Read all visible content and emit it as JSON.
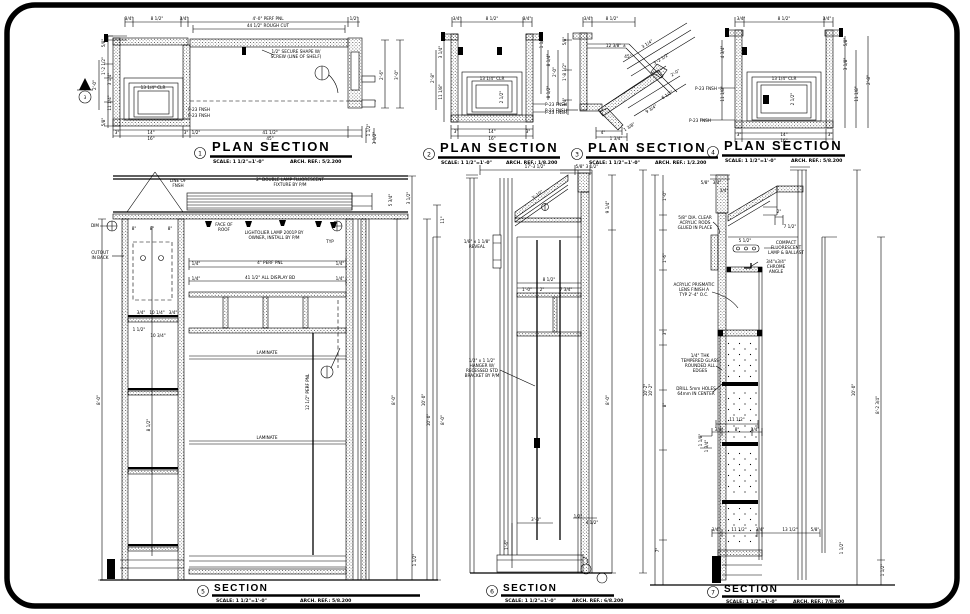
{
  "sheet": {
    "background": "#ffffff",
    "line_color": "#000000"
  },
  "panels": {
    "p1": {
      "num": "1",
      "title": "PLAN SECTION",
      "scale": "SCALE: 1 1/2\"=1'-0\"",
      "ref": "ARCH. REF.: 5/2.200",
      "ann": [
        [
          "3/4\"",
          129,
          20
        ],
        [
          "8 1/2\"",
          157,
          20
        ],
        [
          "3/4\"",
          184,
          20
        ],
        [
          "4'-0\" PERF PNL",
          268,
          20
        ],
        [
          "1/2\"",
          354,
          20
        ],
        [
          "44 1/2\" ROUGH CUT",
          268,
          27
        ],
        [
          "1/2\" SECURE SHAPE W/",
          296,
          53
        ],
        [
          "SCREW (LINE OF SHELF)",
          296,
          58
        ],
        [
          "5/8\"",
          105,
          43,
          -90
        ],
        [
          "1'-2 1/2\"",
          105,
          66,
          -90
        ],
        [
          "3 1/4\"",
          111,
          79,
          -90
        ],
        [
          "11 1/4\"",
          111,
          103,
          -90
        ],
        [
          "5/8\"",
          105,
          122,
          -90
        ],
        [
          "2'-0\"",
          96,
          85,
          -90
        ],
        [
          "13 1/4\" CLR",
          153,
          89
        ],
        [
          "P-23 FNSH",
          199,
          111
        ],
        [
          "P-23 FNSH",
          199,
          117
        ],
        [
          "3\"",
          117,
          134
        ],
        [
          "14\"",
          151,
          134
        ],
        [
          "3\"",
          186,
          134
        ],
        [
          "1/2\"",
          196,
          134
        ],
        [
          "41 1/2\"",
          270,
          134
        ],
        [
          "16\"",
          151,
          140
        ],
        [
          "45\"",
          270,
          140
        ],
        [
          "1 1/2\"",
          370,
          130,
          -90
        ],
        [
          "3 1/2\"",
          376,
          138,
          -90
        ],
        [
          "2'-6\"",
          383,
          75,
          -90
        ],
        [
          "3'-0\"",
          398,
          75,
          -90
        ],
        [
          "3",
          85,
          99
        ]
      ]
    },
    "p2": {
      "num": "2",
      "title": "PLAN SECTION",
      "scale": "SCALE: 1 1/2\"=1'-0\"",
      "ref": "ARCH. REF.: 1/8.200",
      "ann": [
        [
          "3/4\"",
          457,
          20
        ],
        [
          "8 1/2\"",
          492,
          20
        ],
        [
          "3/4\"",
          527,
          20
        ],
        [
          "3 1/4\"",
          442,
          52,
          -90
        ],
        [
          "11 1/8\"",
          442,
          92,
          -90
        ],
        [
          "2'-8\"",
          434,
          78,
          -90
        ],
        [
          "1 1/2\"",
          543,
          42,
          -90
        ],
        [
          "8 1/4\"",
          550,
          60,
          -90
        ],
        [
          "8 1/2\"",
          550,
          92,
          -90
        ],
        [
          "13 1/4\" CLR",
          492,
          80
        ],
        [
          "2 1/2\"",
          503,
          97,
          -90
        ],
        [
          "P-23 FNSH",
          556,
          106
        ],
        [
          "P-23 FNSH",
          556,
          114
        ],
        [
          "3\"",
          456,
          133
        ],
        [
          "14\"",
          492,
          133
        ],
        [
          "3\"",
          528,
          133
        ],
        [
          "16\"",
          492,
          140
        ]
      ]
    },
    "p3": {
      "num": "3",
      "title": "PLAN SECTION",
      "scale": "SCALE: 1 1/2\"=1'-0\"",
      "ref": "ARCH. REF.: 1/2.200",
      "ann": [
        [
          "3/4\"",
          588,
          20
        ],
        [
          "8 1/2\"",
          612,
          20
        ],
        [
          "12 3/8\" ±",
          616,
          47
        ],
        [
          "45°",
          628,
          58
        ],
        [
          "3 1/4\"",
          648,
          45,
          -32
        ],
        [
          "3'-2 1/2\"",
          662,
          60,
          -32
        ],
        [
          "2'-0\"",
          676,
          74,
          -32
        ],
        [
          "6 1/2\"",
          668,
          96,
          -32
        ],
        [
          "9 3/4\"",
          652,
          110,
          -32
        ],
        [
          "5/8\"",
          566,
          41,
          -90
        ],
        [
          "1'-8 1/2\"",
          566,
          72,
          -90
        ],
        [
          "3/4\"",
          566,
          102,
          -90
        ],
        [
          "2'-0\"",
          556,
          72,
          -90
        ],
        [
          "4\"",
          603,
          134
        ],
        [
          "1 3/4\"",
          616,
          140
        ],
        [
          "1 3/8\"",
          630,
          128,
          -32
        ],
        [
          "P-23 FNSH",
          556,
          112
        ]
      ]
    },
    "p4": {
      "num": "4",
      "title": "PLAN SECTION",
      "scale": "SCALE: 1 1/2\"=1'-0\"",
      "ref": "ARCH. REF.: 5/8.200",
      "ann": [
        [
          "3/4\"",
          741,
          20
        ],
        [
          "8 1/2\"",
          784,
          20
        ],
        [
          "3/4\"",
          827,
          20
        ],
        [
          "4 3/4\"",
          724,
          52,
          -90
        ],
        [
          "11 1/8\"",
          724,
          94,
          -90
        ],
        [
          "5/8\"",
          847,
          42,
          -90
        ],
        [
          "3 1/8\"",
          847,
          64,
          -90
        ],
        [
          "11 1/8\"",
          858,
          94,
          -90
        ],
        [
          "2'-8\"",
          870,
          80,
          -90
        ],
        [
          "13 1/4\" CLR",
          784,
          80
        ],
        [
          "2 1/2\"",
          794,
          99,
          -90
        ],
        [
          "P-23 FNSH",
          706,
          90
        ],
        [
          "P-23 FNSH",
          700,
          122
        ],
        [
          "3\"",
          739,
          136
        ],
        [
          "14\"",
          784,
          136
        ],
        [
          "3\"",
          830,
          136
        ],
        [
          "16\"",
          784,
          142
        ]
      ]
    },
    "s5": {
      "num": "5",
      "title": "SECTION",
      "scale": "SCALE: 1 1/2\"=1'-0\"",
      "ref": "ARCH. REF.: 5/8.200",
      "ann": [
        [
          "LINE OF",
          178,
          182
        ],
        [
          "FNSH",
          178,
          187
        ],
        [
          "2\" DOUBLE LAMP FLUORESCENT",
          290,
          181
        ],
        [
          "FIXTURE BY P/M",
          290,
          186
        ],
        [
          "8\"",
          134,
          230
        ],
        [
          "8\"",
          152,
          230
        ],
        [
          "8\"",
          170,
          230
        ],
        [
          "FACE OF",
          224,
          226
        ],
        [
          "ROOF",
          224,
          231
        ],
        [
          "LIGHTOLIER LAMP 2001P BY",
          274,
          234
        ],
        [
          "OWNER, INSTALL BY P/M",
          274,
          239
        ],
        [
          "TYP",
          330,
          243
        ],
        [
          "DIM",
          95,
          227
        ],
        [
          "CUTOUT",
          100,
          254
        ],
        [
          "IN BACK",
          100,
          259
        ],
        [
          "3/4\"",
          141,
          314
        ],
        [
          "10 1/4\"",
          157,
          314
        ],
        [
          "3/4\"",
          173,
          314
        ],
        [
          "1 1/2\"",
          139,
          331
        ],
        [
          "10 3/4\"",
          158,
          337
        ],
        [
          "8 1/2\"",
          150,
          425,
          -90
        ],
        [
          "1/4\"",
          196,
          265
        ],
        [
          "4\" PERF PNL",
          270,
          264
        ],
        [
          "1/4\"",
          340,
          265
        ],
        [
          "1/4\"",
          196,
          280
        ],
        [
          "41 1/2\" ALL DISPLAY BD",
          270,
          279
        ],
        [
          "1/4\"",
          340,
          280
        ],
        [
          "LAMINATE",
          267,
          354
        ],
        [
          "LAMINATE",
          267,
          439
        ],
        [
          "12 1/2\" PERF PNL",
          309,
          392,
          -90
        ],
        [
          "8'-0\"",
          395,
          400,
          -90
        ],
        [
          "10'-0\"",
          425,
          400,
          -90
        ],
        [
          "5 3/4\"",
          392,
          200,
          -90
        ],
        [
          "3 1/2\"",
          410,
          198,
          -90
        ],
        [
          "1 1/2\"",
          416,
          560,
          -90
        ],
        [
          "8'-0\"",
          100,
          400,
          -90
        ]
      ]
    },
    "s6": {
      "num": "6",
      "title": "SECTION",
      "scale": "SCALE: 1 1/2\"=1'-0\"",
      "ref": "ARCH. REF.: 6/8.200",
      "ann": [
        [
          "17'-3 1/2\"",
          535,
          168
        ],
        [
          "5/8\"",
          580,
          168
        ],
        [
          "3 1/2\"",
          592,
          168
        ],
        [
          "11\"",
          444,
          220,
          -90
        ],
        [
          "8'-0\"",
          444,
          420,
          -90
        ],
        [
          "10'-0\"",
          430,
          420,
          -90
        ],
        [
          "1/8\" x 1 1/8\"",
          477,
          243
        ],
        [
          "REVEAL",
          477,
          248
        ],
        [
          "3'-10\"",
          538,
          196,
          -35
        ],
        [
          "8 1/2\"",
          549,
          281
        ],
        [
          "1'-0\"",
          527,
          291
        ],
        [
          "2\"",
          542,
          291
        ],
        [
          "7 3/4\"",
          566,
          291
        ],
        [
          "1/2\" x 1 1/2\"",
          482,
          362
        ],
        [
          "HANGER W/",
          482,
          367
        ],
        [
          "RECESSED STD",
          482,
          372
        ],
        [
          "BRACKET BY P/M",
          482,
          377
        ],
        [
          "3'-0\"",
          536,
          521
        ],
        [
          "1'-6\"",
          508,
          545,
          -90
        ],
        [
          "1/2\"",
          578,
          518
        ],
        [
          "4 1/2\"",
          592,
          524
        ],
        [
          "9 1/4\"",
          609,
          207,
          -90
        ],
        [
          "8'-0\"",
          609,
          400,
          -90
        ],
        [
          "10'-2\"",
          647,
          390,
          -90
        ]
      ]
    },
    "s7": {
      "num": "7",
      "title": "SECTION",
      "scale": "SCALE: 1 1/2\"=1'-0\"",
      "ref": "ARCH. REF.: 7/8.200",
      "ann": [
        [
          "1'-0\"",
          666,
          196,
          -90
        ],
        [
          "1'-6\"",
          666,
          258,
          -90
        ],
        [
          "3\"",
          666,
          333,
          -90
        ],
        [
          "8\"",
          666,
          405,
          -90
        ],
        [
          "7\"",
          659,
          550,
          -90
        ],
        [
          "10'-2\"",
          652,
          390,
          -90
        ],
        [
          "5/8\"",
          705,
          184
        ],
        [
          "3/4\"",
          717,
          184
        ],
        [
          "3/4\"",
          724,
          192
        ],
        [
          "5/8\" DIA. CLEAR",
          695,
          219
        ],
        [
          "ACRYLIC RODS",
          695,
          224
        ],
        [
          "GLUED IN PLACE",
          695,
          229
        ],
        [
          "5 1/2\"",
          745,
          242
        ],
        [
          "2\"",
          779,
          213
        ],
        [
          "7 1/2\"",
          790,
          228
        ],
        [
          "COMPACT",
          786,
          244
        ],
        [
          "FLUORESCENT",
          786,
          249
        ],
        [
          "LAMP & BALLAST",
          786,
          254
        ],
        [
          "3/4\"x3/4\"",
          776,
          263
        ],
        [
          "CHROME",
          776,
          268
        ],
        [
          "ANGLE",
          776,
          273
        ],
        [
          "ACRYLIC PRISMATIC",
          694,
          286
        ],
        [
          "LENS FINISH A",
          694,
          291
        ],
        [
          "TYP 2'-4\" O.C.",
          694,
          296
        ],
        [
          "1/4\" THK",
          700,
          357
        ],
        [
          "TEMPERED GLASS",
          700,
          362
        ],
        [
          "ROUNDED ALL",
          700,
          367
        ],
        [
          "EDGES",
          700,
          372
        ],
        [
          "DRILL 5mm HOLES",
          696,
          390
        ],
        [
          "64mm IN CENTER",
          696,
          395
        ],
        [
          "11 1/2\"",
          737,
          421
        ],
        [
          "3/4\"",
          719,
          431
        ],
        [
          "8\"",
          737,
          431
        ],
        [
          "3/4\"",
          755,
          431
        ],
        [
          "1 1/8\"",
          702,
          440,
          -90
        ],
        [
          "1 3/4\"",
          708,
          446,
          -90
        ],
        [
          "3/4\"",
          716,
          531
        ],
        [
          "11 1/2\"",
          739,
          531
        ],
        [
          "3/4\"",
          760,
          531
        ],
        [
          "13 1/2\"",
          790,
          531
        ],
        [
          "5/8\"",
          815,
          531
        ],
        [
          "10'-0\"",
          855,
          390,
          -90
        ],
        [
          "8'-2 3/4\"",
          879,
          405,
          -90
        ],
        [
          "1 1/2\"",
          843,
          548,
          -90
        ],
        [
          "1 1/2\"",
          884,
          570,
          -90
        ]
      ]
    }
  }
}
